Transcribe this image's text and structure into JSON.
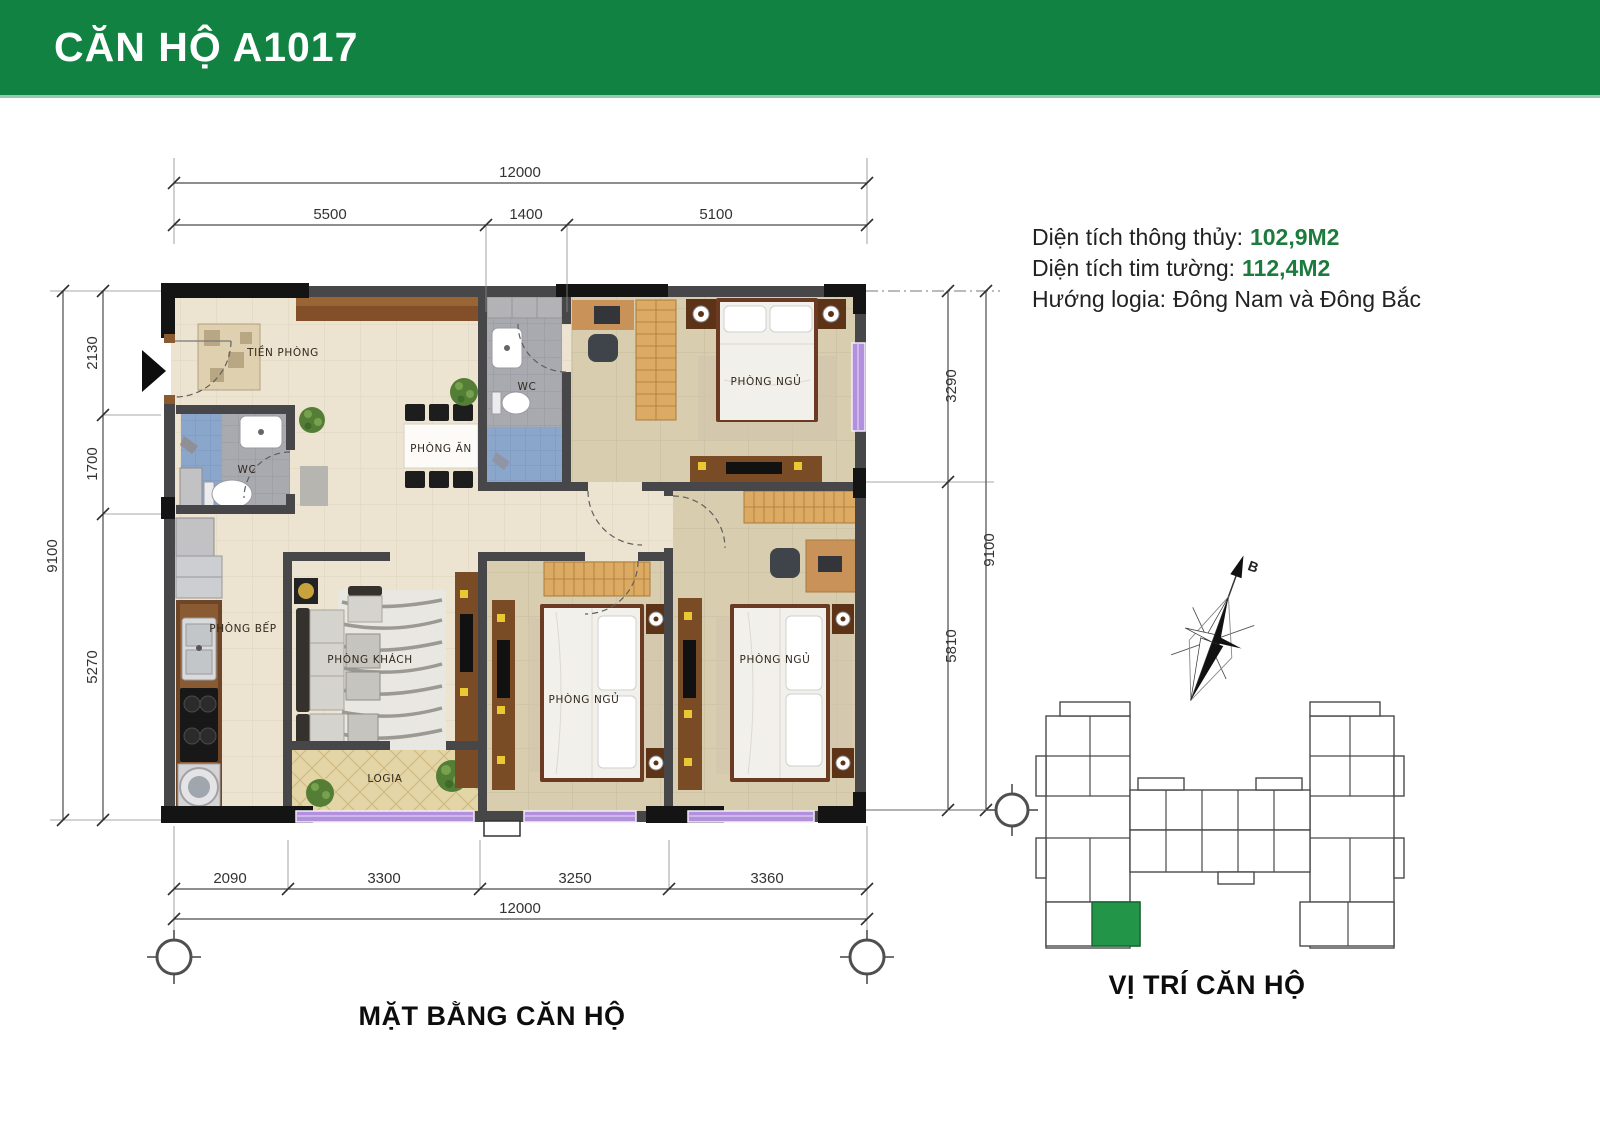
{
  "header": {
    "title": "CĂN HỘ A1017",
    "bg_color": "#118242",
    "text_color": "#ffffff"
  },
  "info": {
    "accent_color": "#1e7b3e",
    "lines": [
      {
        "label": "Diện tích thông thủy:",
        "value": "102,9M2",
        "accent": true
      },
      {
        "label": "Diện tích tim tường:",
        "value": "112,4M2",
        "accent": true
      },
      {
        "label": "Hướng logia:",
        "value": "Đông Nam và  Đông Bắc",
        "accent": false
      }
    ]
  },
  "plan": {
    "caption": "MẶT BẰNG CĂN HỘ",
    "rooms": {
      "entry": "TIỀN PHÒNG",
      "wc1": "WC",
      "wc2": "WC",
      "dining": "PHÒNG ĂN",
      "kitchen": "PHÒNG BẾP",
      "living": "PHÒNG KHÁCH",
      "logia": "LOGIA",
      "bedroom1": "PHÒNG NGỦ",
      "bedroom2": "PHÒNG NGỦ",
      "bedroom3": "PHÒNG NGỦ"
    },
    "dims": {
      "top_total": "12000",
      "top": [
        "5500",
        "1400",
        "5100"
      ],
      "left_total": "9100",
      "left": [
        "2130",
        "1700",
        "5270"
      ],
      "right": [
        "3290",
        "5810"
      ],
      "right_total": "9100",
      "bottom": [
        "2090",
        "3300",
        "3250",
        "3360"
      ],
      "bottom_total": "12000"
    },
    "window_color": "#b290dd"
  },
  "location": {
    "caption": "VỊ TRÍ CĂN HỘ",
    "highlight_color": "#229549"
  },
  "compass": {
    "label": "B"
  }
}
